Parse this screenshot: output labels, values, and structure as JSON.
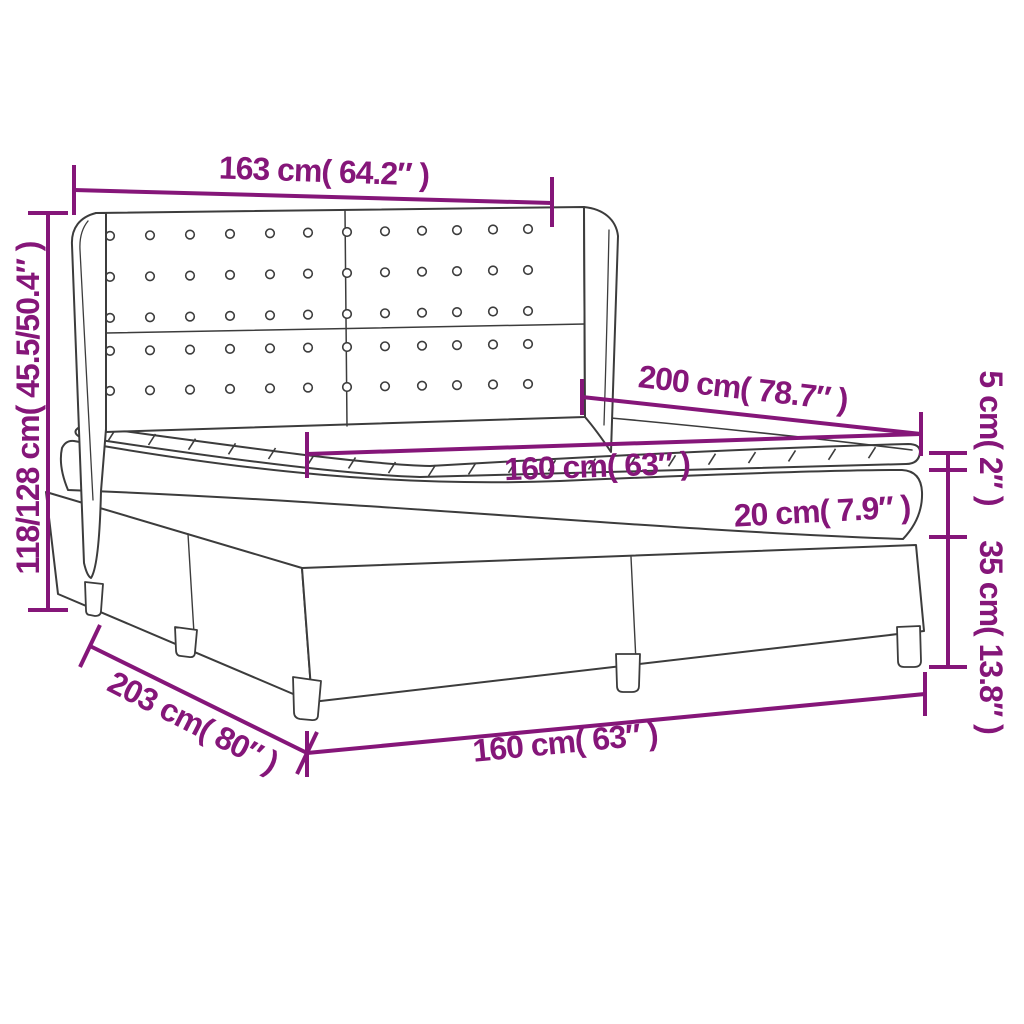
{
  "diagram": {
    "subject": "box-spring-bed-with-headboard-dimension-diagram",
    "accent_color": "#851679",
    "line_color": "#3C3C3C",
    "background_color": "#FFFFFF"
  },
  "measurements": {
    "headboard_width": "163 cm( 64.2″ )",
    "overall_height": "118/128 cm( 45.5/50.4″ )",
    "mattress_length": "200 cm( 78.7″ )",
    "mattress_width": "160 cm( 63″ )",
    "mattress_thickness": "20 cm( 7.9″ )",
    "topper_thickness": "5 cm( 2″ )",
    "base_height": "35 cm( 13.8″ )",
    "overall_length": "203 cm( 80″ )",
    "base_width": "160 cm( 63″ )"
  }
}
